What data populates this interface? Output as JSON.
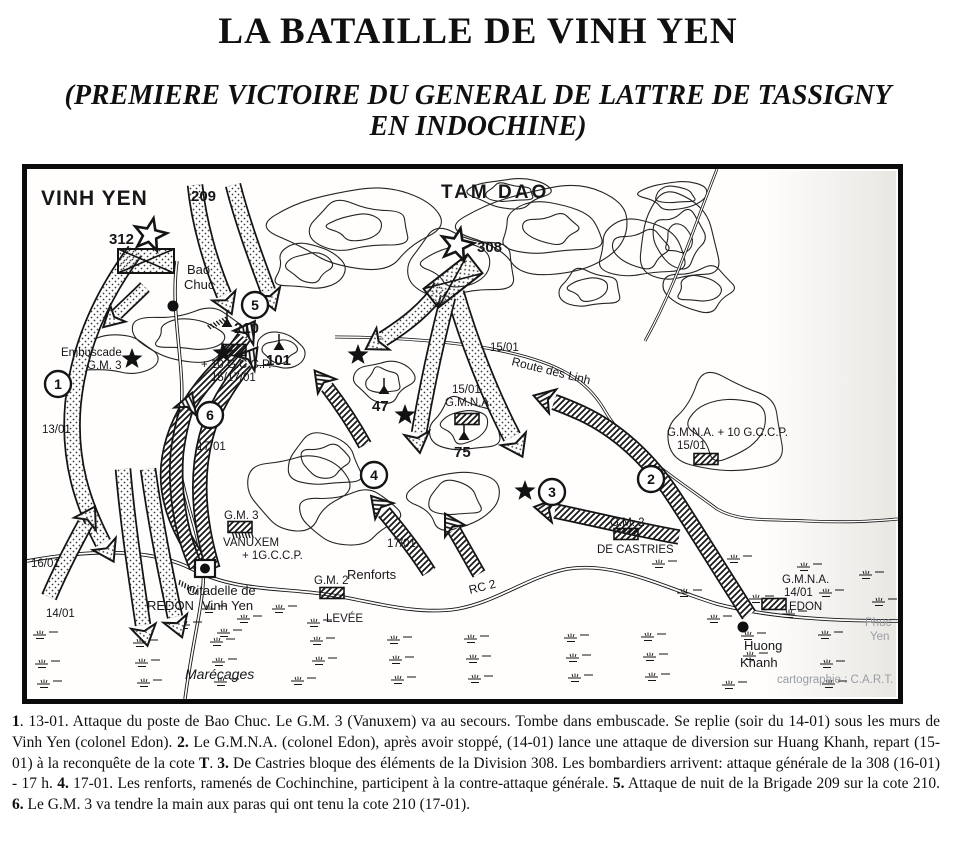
{
  "page": {
    "title": "LA BATAILLE DE VINH YEN",
    "subtitle": "(PREMIERE VICTOIRE DU GENERAL DE LATTRE DE TASSIGNY EN INDOCHINE)"
  },
  "map": {
    "colors": {
      "ink": "#141414",
      "muted": "#989da4",
      "paper": "#fffefd"
    },
    "labels": [
      {
        "name": "label-vinh-yen-region",
        "text": "VINH YEN",
        "x": 14,
        "y": 36,
        "cls": "region"
      },
      {
        "name": "label-209",
        "text": "209",
        "x": 164,
        "y": 32,
        "cls": "big"
      },
      {
        "name": "label-tam-dao-region",
        "text": "TAM DAO",
        "x": 414,
        "y": 29,
        "cls": "region2"
      },
      {
        "name": "label-312",
        "text": "312",
        "x": 82,
        "y": 75,
        "cls": "big"
      },
      {
        "name": "label-308",
        "text": "308",
        "x": 450,
        "y": 83,
        "cls": "big"
      },
      {
        "name": "label-bao",
        "text": "Bao",
        "x": 160,
        "y": 105,
        "cls": "town"
      },
      {
        "name": "label-chuc",
        "text": "Chuc",
        "x": 157,
        "y": 120,
        "cls": "town"
      },
      {
        "name": "label-embuscade",
        "text": "Embuscade",
        "x": 34,
        "y": 187
      },
      {
        "name": "label-embuscade-gm3",
        "text": "G.M. 3",
        "x": 60,
        "y": 200
      },
      {
        "name": "label-date-13-01",
        "text": "13/01",
        "x": 15,
        "y": 264
      },
      {
        "name": "label-date-16-01",
        "text": "16/01",
        "x": 4,
        "y": 398
      },
      {
        "name": "label-date-14-01",
        "text": "14/01",
        "x": 19,
        "y": 448
      },
      {
        "name": "label-cote-210",
        "text": "210",
        "x": 207,
        "y": 164,
        "cls": "big"
      },
      {
        "name": "label-cote-101",
        "text": "101",
        "x": 239,
        "y": 196,
        "cls": "big"
      },
      {
        "name": "label-cote-47",
        "text": "47",
        "x": 345,
        "y": 242,
        "cls": "big"
      },
      {
        "name": "label-cote-75",
        "text": "75",
        "x": 427,
        "y": 288,
        "cls": "big"
      },
      {
        "name": "label-plus-10-gccp",
        "text": "+ 10 G.C.C.P.",
        "x": 174,
        "y": 199
      },
      {
        "name": "label-15-17-01",
        "text": "15/17/01",
        "x": 184,
        "y": 212
      },
      {
        "name": "label-15-01-route",
        "text": "15/01",
        "x": 463,
        "y": 182
      },
      {
        "name": "label-route-des-linh",
        "text": "Route des Linh",
        "x": 484,
        "y": 196,
        "rot": 14,
        "cls": "road"
      },
      {
        "name": "label-15-01-gmna",
        "text": "15/01",
        "x": 425,
        "y": 224
      },
      {
        "name": "label-gmna-center",
        "text": "G.M.N.A.",
        "x": 418,
        "y": 237
      },
      {
        "name": "label-gmna-plus-10-gccp",
        "text": "G.M.N.A. + 10 G.C.C.P.",
        "x": 640,
        "y": 267
      },
      {
        "name": "label-15-01-right",
        "text": "15/01",
        "x": 650,
        "y": 280
      },
      {
        "name": "label-gm2-castries",
        "text": "G.M. 2",
        "x": 583,
        "y": 357
      },
      {
        "name": "label-de-castries",
        "text": "DE CASTRIES",
        "x": 570,
        "y": 384
      },
      {
        "name": "label-gm3-vanuxem-unit",
        "text": "G.M. 3",
        "x": 197,
        "y": 350
      },
      {
        "name": "label-vanuxem",
        "text": "VANUXEM",
        "x": 196,
        "y": 377
      },
      {
        "name": "label-plus-1-gccp",
        "text": "+ 1G.C.C.P.",
        "x": 215,
        "y": 390
      },
      {
        "name": "label-renforts",
        "text": "Renforts",
        "x": 320,
        "y": 410,
        "cls": "town"
      },
      {
        "name": "label-17-01-renforts",
        "text": "17/01",
        "x": 360,
        "y": 378
      },
      {
        "name": "label-17-01-gm3",
        "text": "17/01",
        "x": 170,
        "y": 281
      },
      {
        "name": "label-gm2-levee",
        "text": "G.M. 2",
        "x": 287,
        "y": 415
      },
      {
        "name": "label-rc2",
        "text": "RC 2",
        "x": 443,
        "y": 425,
        "rot": -14,
        "cls": "road"
      },
      {
        "name": "label-levee",
        "text": "LEVÉE",
        "x": 299,
        "y": 453
      },
      {
        "name": "label-citadelle-de",
        "text": "Citadelle de",
        "x": 160,
        "y": 426,
        "cls": "town"
      },
      {
        "name": "label-redon",
        "text": "REDON",
        "x": 120,
        "y": 441,
        "cls": "town"
      },
      {
        "name": "label-vinh-yen-town",
        "text": "Vinh Yen",
        "x": 175,
        "y": 441,
        "cls": "town"
      },
      {
        "name": "label-marecages",
        "text": "Marécages",
        "x": 158,
        "y": 510,
        "cls": "marsh"
      },
      {
        "name": "label-gmna-right",
        "text": "G.M.N.A.",
        "x": 755,
        "y": 414
      },
      {
        "name": "label-14-01-right",
        "text": "14/01",
        "x": 757,
        "y": 427
      },
      {
        "name": "label-edon",
        "text": "EDON",
        "x": 762,
        "y": 441
      },
      {
        "name": "label-huong",
        "text": "Huong",
        "x": 717,
        "y": 481,
        "cls": "town"
      },
      {
        "name": "label-khanh",
        "text": "Khanh",
        "x": 713,
        "y": 498,
        "cls": "town"
      },
      {
        "name": "label-phuc",
        "text": "Phuc",
        "x": 838,
        "y": 457,
        "cls": "gray"
      },
      {
        "name": "label-yen",
        "text": "Yen",
        "x": 843,
        "y": 471,
        "cls": "gray"
      },
      {
        "name": "map-credit",
        "text": "cartographie : C.A.R.T.",
        "x": 750,
        "y": 514,
        "cls": "gray"
      }
    ],
    "markers": [
      {
        "n": "1",
        "x": 31,
        "y": 215
      },
      {
        "n": "2",
        "x": 624,
        "y": 310
      },
      {
        "n": "3",
        "x": 525,
        "y": 323
      },
      {
        "n": "4",
        "x": 347,
        "y": 306
      },
      {
        "n": "5",
        "x": 228,
        "y": 136
      },
      {
        "n": "6",
        "x": 183,
        "y": 246
      }
    ],
    "stars_filled": [
      [
        105,
        190
      ],
      [
        196,
        184
      ],
      [
        331,
        186
      ],
      [
        378,
        246
      ],
      [
        498,
        322
      ]
    ],
    "stars_outline": [
      [
        123,
        66
      ],
      [
        430,
        76
      ]
    ],
    "town_dots": [
      [
        146,
        137
      ],
      [
        716,
        458
      ]
    ],
    "division_boxes": [
      [
        119,
        92,
        0
      ],
      [
        426,
        112,
        -38
      ]
    ],
    "unit_boxes": [
      [
        207,
        181
      ],
      [
        440,
        250
      ],
      [
        679,
        290
      ],
      [
        599,
        365
      ],
      [
        213,
        358
      ],
      [
        305,
        424
      ],
      [
        747,
        435
      ]
    ],
    "summits": [
      [
        200,
        153
      ],
      [
        252,
        176
      ],
      [
        357,
        220
      ],
      [
        437,
        266
      ]
    ],
    "citadel": {
      "x": 168,
      "y": 391,
      "w": 20,
      "h": 17
    }
  },
  "caption": {
    "segments": [
      {
        "b": true,
        "t": "1"
      },
      {
        "b": false,
        "t": ". 13-01. Attaque du poste de Bao Chuc. Le G.M. 3 (Vanuxem) va au secours. Tombe dans embuscade. Se replie (soir du 14-01) sous les murs de Vinh Yen (colonel Edon). "
      },
      {
        "b": true,
        "t": "2."
      },
      {
        "b": false,
        "t": " Le G.M.N.A. (colonel Edon), après avoir stoppé, (14-01) lance une attaque de diversion sur Huang Khanh, repart (15-01) à la reconquête de la cote "
      },
      {
        "b": true,
        "t": "T"
      },
      {
        "b": false,
        "t": ". "
      },
      {
        "b": true,
        "t": "3."
      },
      {
        "b": false,
        "t": " De Castries bloque des éléments de la Division 308. Les bombardiers arrivent: attaque générale de la 308 (16-01) - 17 h. "
      },
      {
        "b": true,
        "t": "4."
      },
      {
        "b": false,
        "t": " 17-01. Les renforts, ramenés de Cochinchine, participent à la contre-attaque générale. "
      },
      {
        "b": true,
        "t": "5."
      },
      {
        "b": false,
        "t": " Attaque de nuit de la Brigade 209 sur la cote 210. "
      },
      {
        "b": true,
        "t": "6."
      },
      {
        "b": false,
        "t": " Le G.M. 3 va tendre la main aux paras qui ont tenu la cote 210 (17-01)."
      }
    ]
  }
}
